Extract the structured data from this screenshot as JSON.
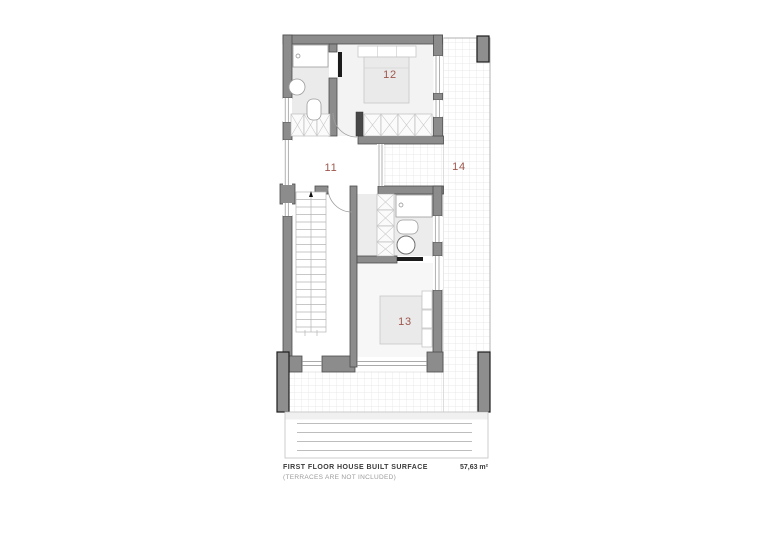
{
  "rooms": [
    {
      "number": "11"
    },
    {
      "number": "12"
    },
    {
      "number": "13"
    },
    {
      "number": "14"
    }
  ],
  "footer": {
    "line1": "FIRST FLOOR HOUSE BUILT SURFACE",
    "line2": "(TERRACES ARE NOT INCLUDED)",
    "area": "57,63 m²"
  },
  "colors": {
    "room_number": "#9e564c",
    "wall": "#8c8c8c",
    "wall_outline": "#4d4d4d",
    "terrace_grid": "#e2e2e2"
  }
}
